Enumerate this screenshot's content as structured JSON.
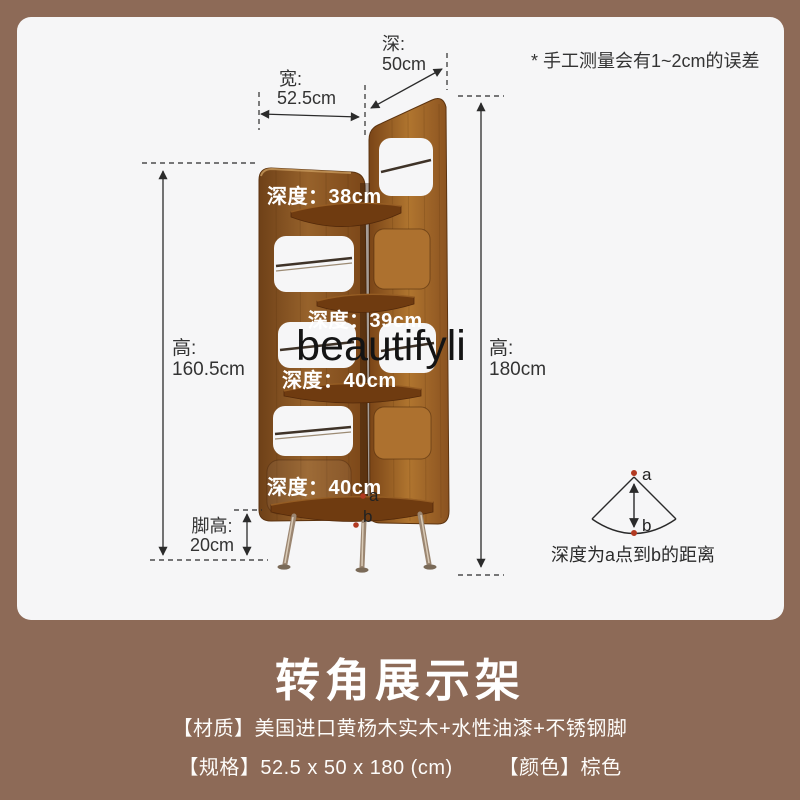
{
  "colors": {
    "page_bg": "#8d6a57",
    "card_bg": "#f6f6f7",
    "wood_mid": "#97622b",
    "wood_light": "#b0752f",
    "wood_dark": "#6f3b10",
    "accent_red": "#b23a22",
    "text_dark": "#333333",
    "white": "#ffffff"
  },
  "note": "* 手工测量会有1~2cm的误差",
  "dims": {
    "depth_label": "深:",
    "depth_value": "50cm",
    "width_label": "宽:",
    "width_value": "52.5cm",
    "height_left_label": "高:",
    "height_left_value": "160.5cm",
    "height_right_label": "高:",
    "height_right_value": "180cm",
    "leg_label": "脚高:",
    "leg_value": "20cm"
  },
  "shelf_depths": [
    "深度：38cm",
    "深度：39cm",
    "深度：40cm",
    "深度：40cm"
  ],
  "points": {
    "a": "a",
    "b": "b"
  },
  "fan": {
    "a": "a",
    "b": "b",
    "caption": "深度为a点到b的距离"
  },
  "watermark": "beautifyli",
  "footer": {
    "title": "转角展示架",
    "material": "【材质】美国进口黄杨木实木+水性油漆+不锈钢脚",
    "spec": "【规格】52.5 x 50 x 180 (cm)",
    "color": "【颜色】棕色"
  }
}
